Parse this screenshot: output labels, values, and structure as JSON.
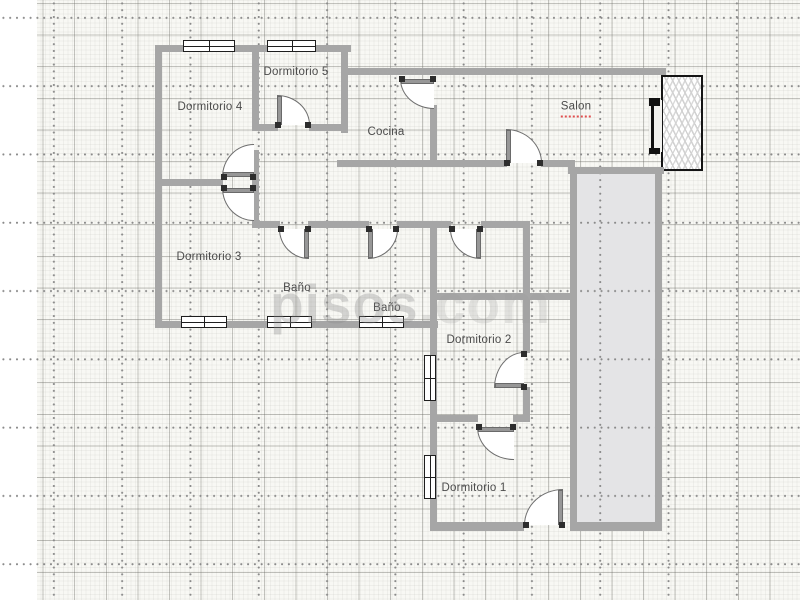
{
  "watermark": {
    "brand": "pisos",
    "suffix": ".com"
  },
  "rooms": [
    {
      "label": "Dormitorio 4",
      "x": 210,
      "y": 107,
      "squiggle": false
    },
    {
      "label": "Dormitorio 5",
      "x": 296,
      "y": 72,
      "squiggle": false
    },
    {
      "label": "Cocina",
      "x": 386,
      "y": 132,
      "squiggle": false
    },
    {
      "label": "Salon",
      "x": 576,
      "y": 109,
      "squiggle": true
    },
    {
      "label": "Dormitorio 3",
      "x": 209,
      "y": 257,
      "squiggle": false
    },
    {
      "label": "Baño",
      "x": 297,
      "y": 288,
      "squiggle": false
    },
    {
      "label": "Baño",
      "x": 387,
      "y": 308,
      "squiggle": false
    },
    {
      "label": "Dormitorio 2",
      "x": 479,
      "y": 340,
      "squiggle": false
    },
    {
      "label": "Dormitorio 1",
      "x": 474,
      "y": 488,
      "squiggle": false
    }
  ],
  "plan": {
    "colors": {
      "wall": "#a6a6a6",
      "patio_fill": "#e4e4e6",
      "label_text": "#4b4b4b",
      "squiggle": "#e04f4f",
      "grid_dot": "#8a8a8a",
      "window_frame": "#1e1e1e"
    },
    "walls": [
      [
        155,
        45,
        196,
        7
      ],
      [
        155,
        45,
        7,
        283
      ],
      [
        155,
        321,
        283,
        7
      ],
      [
        252,
        45,
        7,
        86
      ],
      [
        252,
        124,
        26,
        7
      ],
      [
        309,
        124,
        39,
        7
      ],
      [
        341,
        45,
        7,
        88
      ],
      [
        155,
        179,
        68,
        7
      ],
      [
        252,
        150,
        7,
        78
      ],
      [
        345,
        68,
        321,
        7
      ],
      [
        430,
        105,
        7,
        62
      ],
      [
        337,
        160,
        170,
        7
      ],
      [
        541,
        160,
        34,
        7
      ],
      [
        568,
        167,
        96,
        7
      ],
      [
        570,
        174,
        7,
        356
      ],
      [
        655,
        174,
        7,
        356
      ],
      [
        570,
        522,
        92,
        9
      ],
      [
        252,
        221,
        28,
        7
      ],
      [
        308,
        221,
        61,
        7
      ],
      [
        397,
        221,
        54,
        7
      ],
      [
        481,
        221,
        49,
        7
      ],
      [
        430,
        228,
        7,
        302
      ],
      [
        430,
        293,
        142,
        7
      ],
      [
        523,
        223,
        7,
        130
      ],
      [
        523,
        387,
        7,
        35
      ],
      [
        430,
        415,
        48,
        7
      ],
      [
        513,
        415,
        17,
        7
      ],
      [
        430,
        522,
        94,
        9
      ]
    ],
    "windows": [
      {
        "x": 183,
        "y": 40,
        "w": 52,
        "h": 12,
        "style": "pane"
      },
      {
        "x": 267,
        "y": 40,
        "w": 49,
        "h": 12,
        "style": "pane"
      },
      {
        "x": 181,
        "y": 316,
        "w": 46,
        "h": 12,
        "style": "pane"
      },
      {
        "x": 267,
        "y": 316,
        "w": 45,
        "h": 12,
        "style": "pane"
      },
      {
        "x": 359,
        "y": 316,
        "w": 45,
        "h": 12,
        "style": "pane"
      },
      {
        "x": 424,
        "y": 355,
        "w": 12,
        "h": 46,
        "style": "pane"
      },
      {
        "x": 424,
        "y": 455,
        "w": 12,
        "h": 44,
        "style": "pane"
      },
      {
        "x": 649,
        "y": 100,
        "w": 13,
        "h": 52,
        "style": "bar"
      }
    ],
    "doors": [
      {
        "x": 222,
        "y": 144,
        "w": 32,
        "h": 33,
        "corner": "tl",
        "leaf": "bottom",
        "wall": "bottom"
      },
      {
        "x": 222,
        "y": 188,
        "w": 32,
        "h": 33,
        "corner": "bl",
        "leaf": "top",
        "wall": "top"
      },
      {
        "x": 277,
        "y": 95,
        "w": 33,
        "h": 30,
        "corner": "tr",
        "leaf": "left",
        "wall": "bottom"
      },
      {
        "x": 400,
        "y": 79,
        "w": 34,
        "h": 30,
        "corner": "bl",
        "leaf": "top",
        "wall": "top"
      },
      {
        "x": 279,
        "y": 229,
        "w": 30,
        "h": 30,
        "corner": "bl",
        "leaf": "right",
        "wall": "top"
      },
      {
        "x": 368,
        "y": 229,
        "w": 30,
        "h": 30,
        "corner": "br",
        "leaf": "left",
        "wall": "top"
      },
      {
        "x": 450,
        "y": 229,
        "w": 31,
        "h": 30,
        "corner": "bl",
        "leaf": "right",
        "wall": "top"
      },
      {
        "x": 506,
        "y": 129,
        "w": 36,
        "h": 34,
        "corner": "tr",
        "leaf": "left",
        "wall": "bottom"
      },
      {
        "x": 494,
        "y": 352,
        "w": 30,
        "h": 36,
        "corner": "tl",
        "leaf": "bottom",
        "wall": "right"
      },
      {
        "x": 477,
        "y": 427,
        "w": 37,
        "h": 33,
        "corner": "bl",
        "leaf": "top",
        "wall": "top"
      },
      {
        "x": 524,
        "y": 489,
        "w": 39,
        "h": 36,
        "corner": "tl",
        "leaf": "right",
        "wall": "bottom"
      }
    ],
    "patio": {
      "x": 577,
      "y": 174,
      "w": 78,
      "h": 348
    },
    "radiator": {
      "x": 661,
      "y": 75,
      "w": 42,
      "h": 96
    }
  }
}
